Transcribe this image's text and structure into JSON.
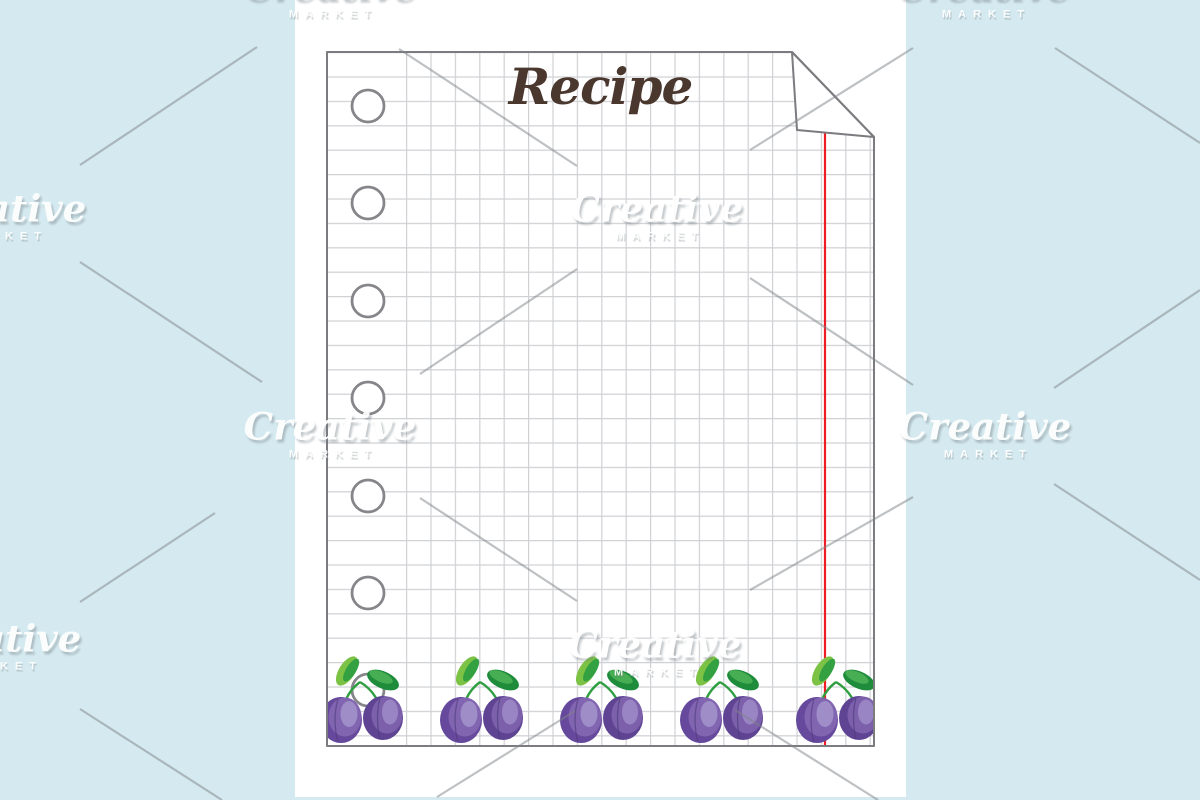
{
  "page": {
    "background_color": "#d5eaf0",
    "card_color": "#ffffff",
    "description": "recipe card stationery template preview"
  },
  "recipe_card": {
    "title": "Recipe",
    "title_color": "#4a372e",
    "paper": {
      "type": "squared notebook sheet",
      "grid_color": "#d0d1d5",
      "border_color": "#7b7b80",
      "margin_line_color": "#ee1c25",
      "hole_count": 7,
      "hole_color": "#85858a",
      "corner_fold": "top-right",
      "decoration": "plum-illustration",
      "plum_group_count": 5,
      "colors": {
        "plum_dark": "#5f4494",
        "plum_mid": "#7c60ab",
        "plum_light": "#a291cb",
        "leaf_light": "#7cc244",
        "leaf_dark": "#1e8c3b",
        "stem": "#2f9e41"
      }
    }
  },
  "watermark": {
    "brand_script": "Creative",
    "brand_caps": "MARKET",
    "line_color": "rgba(125,132,136,0.5)",
    "logos": [
      {
        "x": 330,
        "y": -6
      },
      {
        "x": 983,
        "y": -6
      },
      {
        "x": 0,
        "y": 216
      },
      {
        "x": 657,
        "y": 216
      },
      {
        "x": 330,
        "y": 434
      },
      {
        "x": 985,
        "y": 434
      },
      {
        "x": -5,
        "y": 646
      },
      {
        "x": 655,
        "y": 652
      }
    ],
    "lines": [
      [
        399,
        49,
        577,
        166
      ],
      [
        913,
        48,
        750,
        150
      ],
      [
        80,
        165,
        257,
        47
      ],
      [
        80,
        262,
        262,
        382
      ],
      [
        420,
        374,
        577,
        269
      ],
      [
        750,
        278,
        913,
        385
      ],
      [
        1055,
        48,
        1200,
        143
      ],
      [
        1054,
        388,
        1200,
        290
      ],
      [
        420,
        498,
        577,
        601
      ],
      [
        750,
        590,
        913,
        497
      ],
      [
        80,
        602,
        215,
        513
      ],
      [
        1054,
        484,
        1200,
        580
      ],
      [
        437,
        797,
        575,
        711
      ],
      [
        735,
        710,
        878,
        800
      ],
      [
        80,
        709,
        222,
        800
      ]
    ]
  }
}
